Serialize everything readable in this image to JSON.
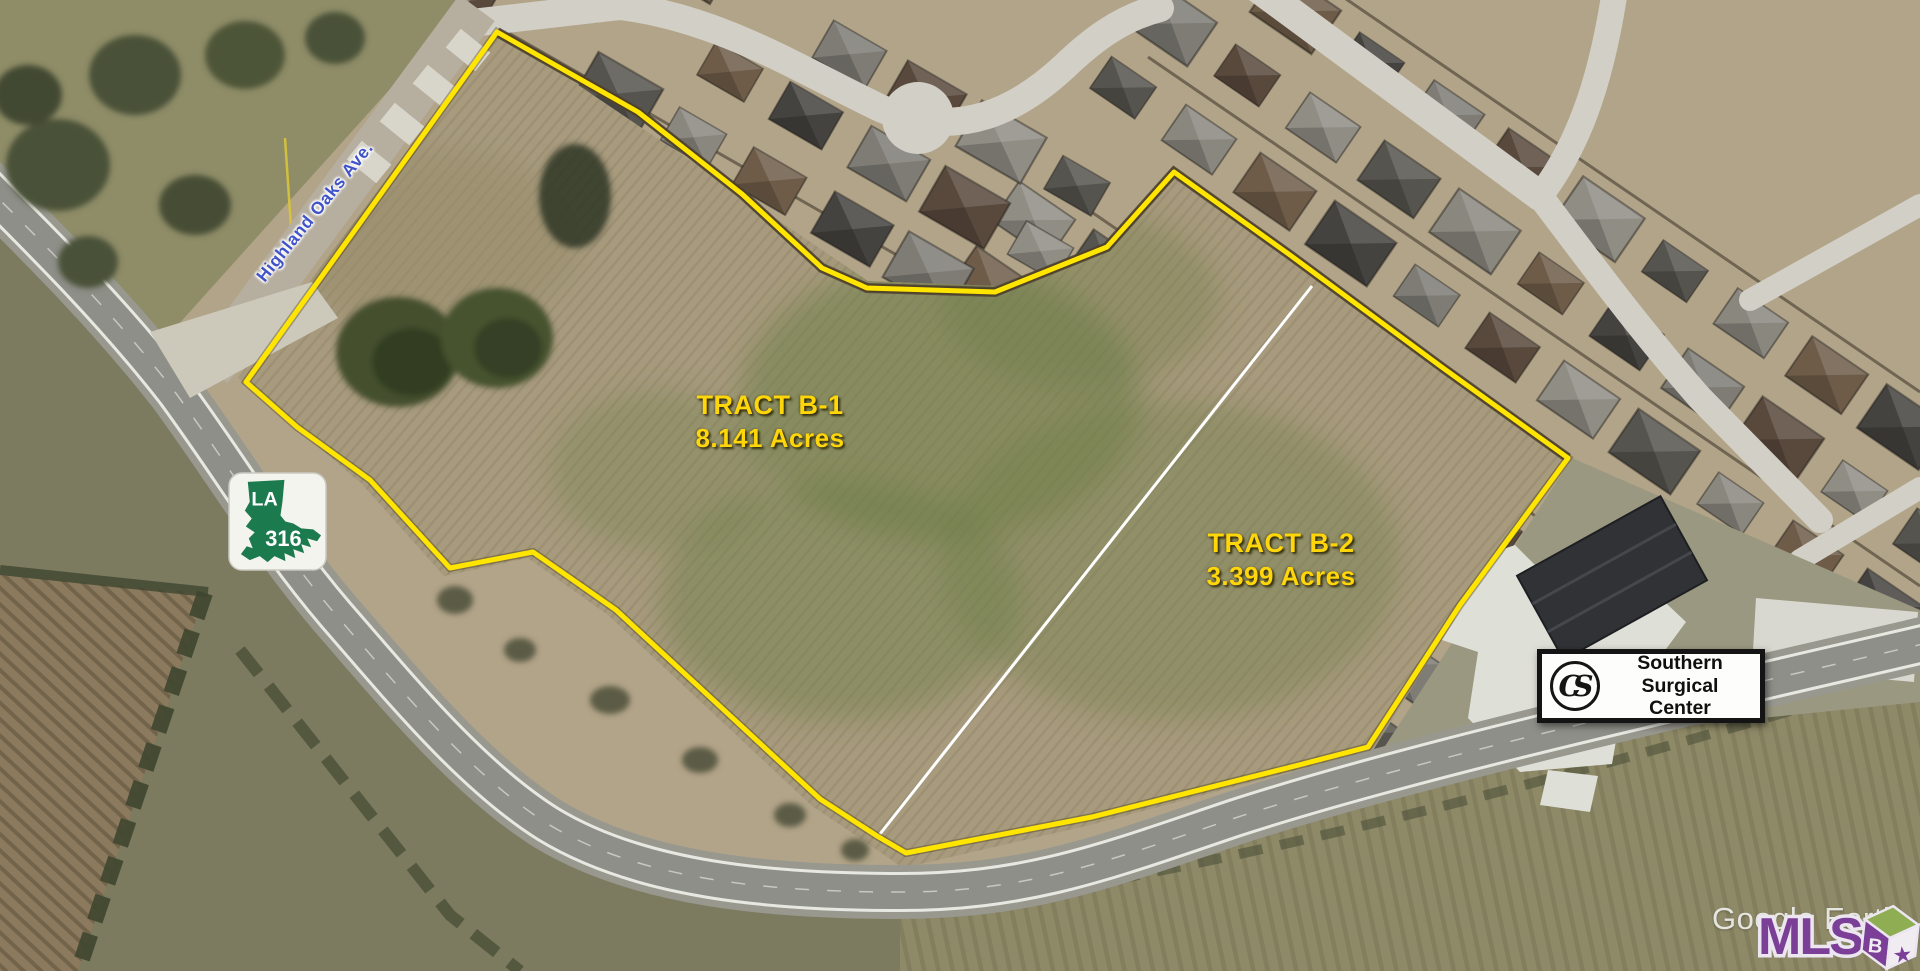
{
  "map": {
    "credit": "Google Earth",
    "type": "aerial-imagery"
  },
  "road_label": {
    "text": "Highland Oaks Ave."
  },
  "highway_shield": {
    "state": "LA",
    "route": "316"
  },
  "tracts": [
    {
      "name": "TRACT B-1",
      "area": "8.141 Acres"
    },
    {
      "name": "TRACT B-2",
      "area": "3.399 Acres"
    }
  ],
  "sign": {
    "monogram": "CS",
    "line1": "Southern",
    "line2": "Surgical Center"
  },
  "watermark": {
    "text": "Google Earth"
  },
  "mls_logo": {
    "text": "MLS",
    "cube_letter": "B"
  },
  "colors": {
    "boundary_yellow": "#FFE500",
    "divider_white": "#FFFFFF",
    "label_yellow": "#FFD60A",
    "road_label_blue": "#4053C8",
    "shield_green": "#1C7A4F",
    "mls_purple": "#7C3F97",
    "mls_green": "#8FAE53",
    "sign_black": "#141414"
  }
}
